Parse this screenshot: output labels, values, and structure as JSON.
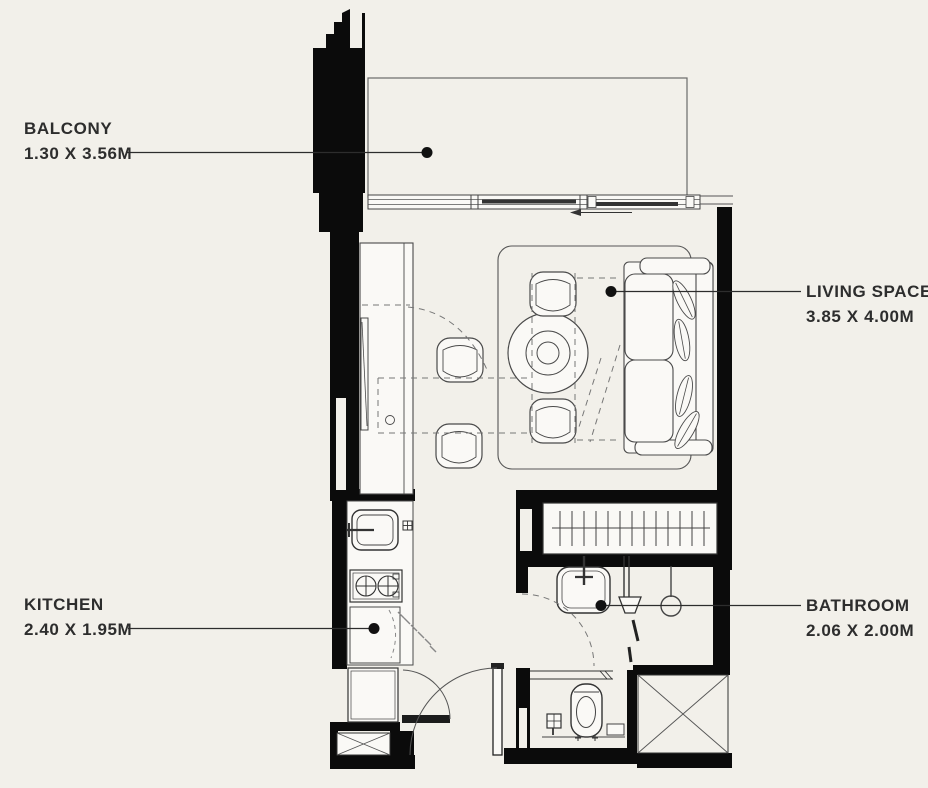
{
  "title": "Studio apartment floor plan",
  "labels": {
    "balcony": {
      "name": "BALCONY",
      "dimensions": "1.30 X 3.56M"
    },
    "living": {
      "name": "LIVING SPACE",
      "dimensions": "3.85 X 4.00M"
    },
    "kitchen": {
      "name": "KITCHEN",
      "dimensions": "2.40 X 1.95M"
    },
    "bathroom": {
      "name": "BATHROOM",
      "dimensions": "2.06 X 2.00M"
    }
  },
  "colors": {
    "background": "#f2f0ea",
    "walls": "#0b0b0b",
    "lines": "#4a4a4a",
    "text": "#2d2d2d"
  }
}
